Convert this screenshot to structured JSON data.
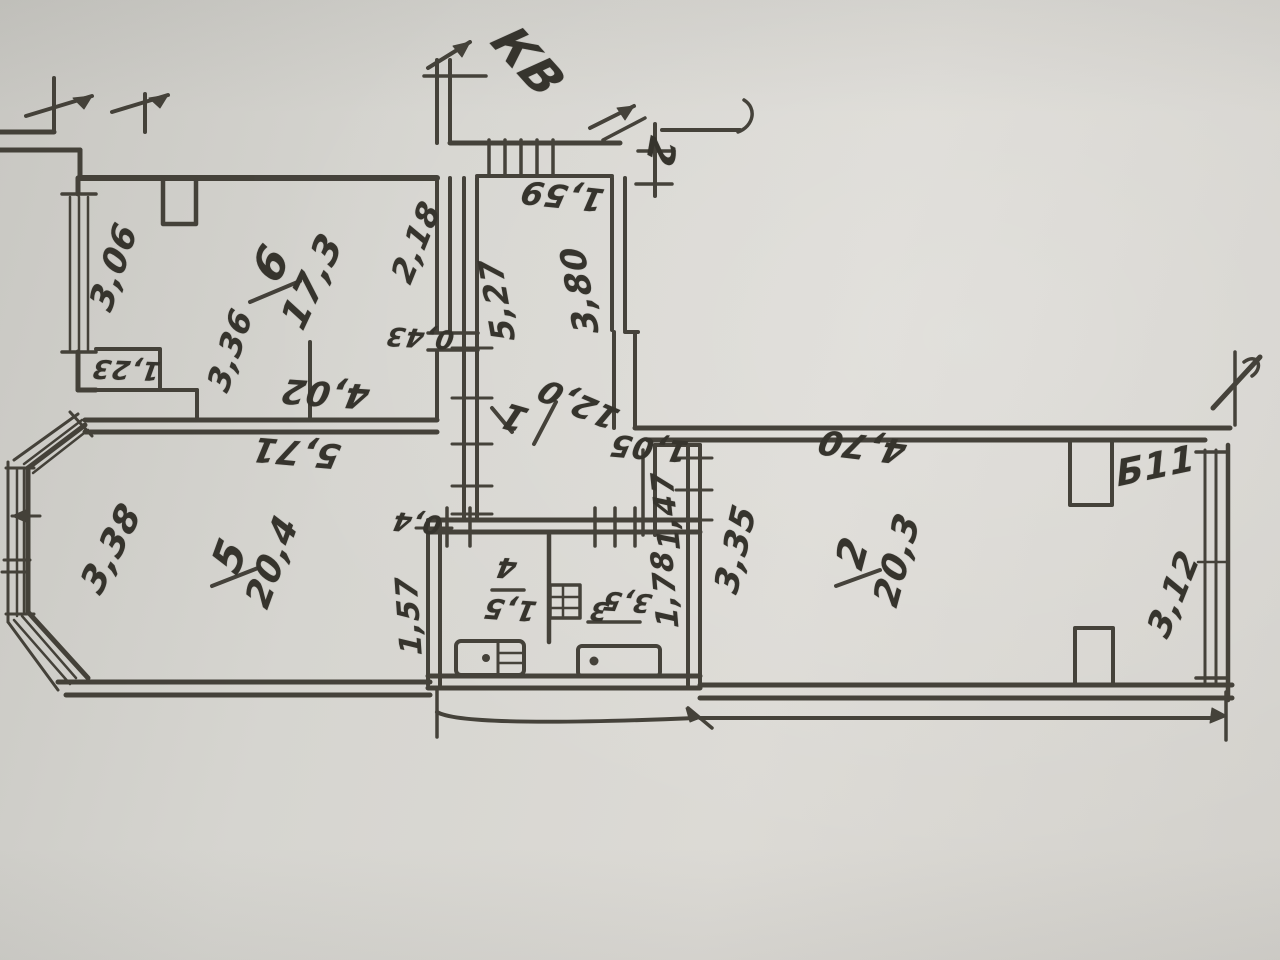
{
  "document": {
    "kind_label": "hand-drawn floor plan sketch",
    "apartment_label": "КВ",
    "apartment_number": "2"
  },
  "rooms": {
    "r1": {
      "number": "1",
      "area": "12,0"
    },
    "r2": {
      "number": "2",
      "area": "20,3"
    },
    "r3": {
      "number": "3",
      "area": "3,5"
    },
    "r4": {
      "number": "4",
      "area": "1,5"
    },
    "r5": {
      "number": "5",
      "area": "20,4"
    },
    "r6": {
      "number": "6",
      "area": "17,3"
    }
  },
  "balcony": {
    "label": "Б11",
    "length": "3,12"
  },
  "dimensions": {
    "d306": "3,06",
    "d123": "1,23",
    "d336": "3,36",
    "d402": "4,02",
    "d218": "2,18",
    "d527": "5,27",
    "d380": "3,80",
    "d159": "1,59",
    "d043": "0,43",
    "d571": "5,71",
    "d338": "3,38",
    "d157": "1,57",
    "d04": "0,4",
    "d178": "1,78",
    "d105": "1,05",
    "d147": "1,47",
    "d470": "4,70",
    "d335": "3,35",
    "d312": "3,12"
  },
  "colors": {
    "paper": "#d6d5d0",
    "ink": "#3a372f"
  }
}
